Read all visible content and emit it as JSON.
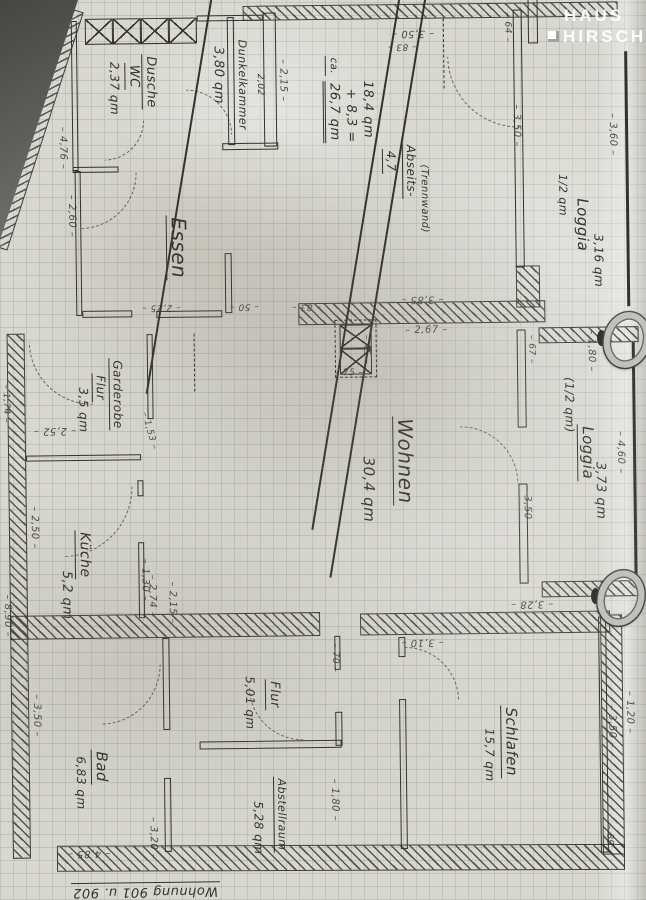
{
  "logo": {
    "line1": "HAUS",
    "line2": "HIRSCH"
  },
  "caption": "Wohnung 901 u. 902",
  "rooms": [
    {
      "name": "Dusche WC",
      "area": "2,37 qm"
    },
    {
      "name": "Dunkelkammer",
      "area": "3,80 qm"
    },
    {
      "name": "Essen",
      "area": ""
    },
    {
      "name": "Loggia (1/2 qm)",
      "area": "3,16 qm"
    },
    {
      "name": "Wohnen",
      "area": "30,4 qm"
    },
    {
      "name": "Loggia (1/2 qm)",
      "area": "3,73 qm"
    },
    {
      "name": "Garderobe Flur",
      "area": "3,5 qm"
    },
    {
      "name": "Küche",
      "area": "5,2 qm"
    },
    {
      "name": "Bad",
      "area": "6,83 qm"
    },
    {
      "name": "Flur",
      "area": "5,01 qm"
    },
    {
      "name": "Abstellraum",
      "area": "5,28 qm"
    },
    {
      "name": "Schlafen",
      "area": "15,7 qm"
    }
  ],
  "plan": {
    "ink": "#34322c",
    "labels": [
      {
        "t": "Dusche",
        "x": 154,
        "y": 80,
        "r": 90,
        "s": 13,
        "u": 1,
        "n": "room-label-dusche"
      },
      {
        "t": "WC",
        "x": 137,
        "y": 74,
        "r": 90,
        "s": 13,
        "u": 1,
        "n": "room-label-wc"
      },
      {
        "t": "2,37 qm",
        "x": 119,
        "y": 86,
        "r": 90,
        "s": 12,
        "n": "area-dusche-wc"
      },
      {
        "t": "Dunkelkammer",
        "x": 247,
        "y": 84,
        "r": 90,
        "s": 11,
        "n": "room-label-dunkelkammer"
      },
      {
        "t": "3,80 qm",
        "x": 223,
        "y": 74,
        "r": 90,
        "s": 13,
        "n": "area-dunkelkammer"
      },
      {
        "t": "2,52",
        "x": 209,
        "y": 48,
        "r": 90,
        "s": 10,
        "strike": 1,
        "n": "crossed-out-number"
      },
      {
        "t": "2,02",
        "x": 264,
        "y": 84,
        "r": 90,
        "s": 9,
        "n": "dimension"
      },
      {
        "t": "Essen",
        "x": 180,
        "y": 246,
        "r": 90,
        "s": 20,
        "u": 1,
        "n": "room-label-essen"
      },
      {
        "t": "1/2 qm",
        "x": 566,
        "y": 198,
        "r": 90,
        "s": 11,
        "n": "note-half-qm"
      },
      {
        "t": "Loggia",
        "x": 585,
        "y": 228,
        "r": 90,
        "s": 15,
        "n": "room-label-loggia-top"
      },
      {
        "t": "3,16 qm",
        "x": 601,
        "y": 264,
        "r": 90,
        "s": 12,
        "n": "area-loggia-top"
      },
      {
        "t": "ca.",
        "x": 336,
        "y": 66,
        "r": 90,
        "s": 10,
        "u": 1,
        "n": "calc-note"
      },
      {
        "t": "18,4 qm",
        "x": 372,
        "y": 110,
        "r": 90,
        "s": 13,
        "n": "calc-line"
      },
      {
        "t": "+ 8,3 =",
        "x": 355,
        "y": 116,
        "r": 90,
        "s": 13,
        "n": "calc-line"
      },
      {
        "t": "26,7 qm",
        "x": 336,
        "y": 112,
        "r": 90,
        "s": 13,
        "u2": 1,
        "n": "calc-sum"
      },
      {
        "t": "22,0",
        "x": 373,
        "y": 176,
        "r": 90,
        "s": 18,
        "strike": 1,
        "n": "calc-crossed"
      },
      {
        "t": "4,7",
        "x": 393,
        "y": 162,
        "r": 90,
        "s": 12,
        "u": 1,
        "n": "calc-line"
      },
      {
        "t": "26,8 qm",
        "x": 391,
        "y": 206,
        "r": 90,
        "s": 13,
        "strike": 1,
        "n": "calc-crossed"
      },
      {
        "t": "Abseits-",
        "x": 413,
        "y": 172,
        "r": 90,
        "s": 12,
        "u": 1,
        "n": "note-abseits"
      },
      {
        "t": "(Trennwand)",
        "x": 427,
        "y": 200,
        "r": 90,
        "s": 10,
        "n": "note-trennwand"
      },
      {
        "t": "Wohnen",
        "x": 404,
        "y": 462,
        "r": 90,
        "s": 20,
        "u": 1,
        "n": "room-label-wohnen"
      },
      {
        "t": "30,4 qm",
        "x": 368,
        "y": 490,
        "r": 90,
        "s": 15,
        "n": "area-wohnen"
      },
      {
        "t": "(1/2 qm)",
        "x": 570,
        "y": 408,
        "r": 90,
        "s": 12,
        "n": "note-half-qm"
      },
      {
        "t": "Loggia",
        "x": 586,
        "y": 456,
        "r": 90,
        "s": 15,
        "u": 1,
        "n": "room-label-loggia-mid"
      },
      {
        "t": "3,73 qm",
        "x": 600,
        "y": 494,
        "r": 90,
        "s": 13,
        "n": "area-loggia-mid"
      },
      {
        "t": "Garderobe",
        "x": 117,
        "y": 392,
        "r": 90,
        "s": 12,
        "u": 1,
        "n": "room-label-garderobe"
      },
      {
        "t": "Flur",
        "x": 100,
        "y": 385,
        "r": 90,
        "s": 12,
        "u": 1,
        "n": "room-label-garderobe-flur"
      },
      {
        "t": "3,5 qm",
        "x": 84,
        "y": 407,
        "r": 90,
        "s": 12,
        "n": "area-garderobe"
      },
      {
        "t": "Küche",
        "x": 82,
        "y": 552,
        "r": 90,
        "s": 14,
        "u": 1,
        "n": "room-label-kueche"
      },
      {
        "t": "5,2 qm",
        "x": 65,
        "y": 592,
        "r": 90,
        "s": 13,
        "n": "area-kueche"
      },
      {
        "t": "Bad",
        "x": 96,
        "y": 764,
        "r": 90,
        "s": 15,
        "u": 1,
        "n": "room-label-bad"
      },
      {
        "t": "6,83 qm",
        "x": 77,
        "y": 780,
        "r": 90,
        "s": 12,
        "n": "area-bad"
      },
      {
        "t": "Flur",
        "x": 270,
        "y": 694,
        "r": 90,
        "s": 13,
        "u": 1,
        "n": "room-label-flur"
      },
      {
        "t": "5,01 qm",
        "x": 247,
        "y": 702,
        "r": 90,
        "s": 12,
        "n": "area-flur"
      },
      {
        "t": "Abstellraum",
        "x": 276,
        "y": 814,
        "r": 90,
        "s": 11,
        "u": 1,
        "n": "room-label-abstellraum"
      },
      {
        "t": "5,28 qm",
        "x": 254,
        "y": 827,
        "r": 90,
        "s": 12,
        "n": "area-abstellraum"
      },
      {
        "t": "Schlafen",
        "x": 506,
        "y": 744,
        "r": 90,
        "s": 15,
        "u": 1,
        "n": "room-label-schlafen"
      },
      {
        "t": "15,7 qm",
        "x": 486,
        "y": 757,
        "r": 90,
        "s": 12,
        "n": "area-schlafen"
      },
      {
        "t": "Wohnung 901 u. 902",
        "x": 140,
        "y": 888,
        "r": 180,
        "s": 13,
        "u": 1,
        "n": "sheet-caption"
      },
      {
        "t": "2,15",
        "x": 287,
        "y": 80,
        "r": 90,
        "s": 10,
        "dim": 1,
        "n": "dimension"
      },
      {
        "t": "4,76",
        "x": 66,
        "y": 145,
        "r": 90,
        "s": 10,
        "dim": 1,
        "n": "dimension"
      },
      {
        "t": "2,60",
        "x": 74,
        "y": 213,
        "r": 90,
        "s": 10,
        "dim": 1,
        "n": "dimension"
      },
      {
        "t": "3,50",
        "x": 418,
        "y": 34,
        "r": 180,
        "s": 10,
        "dim": 1,
        "n": "dimension"
      },
      {
        "t": "83",
        "x": 407,
        "y": 47,
        "r": 180,
        "s": 9,
        "dim": 1,
        "n": "dimension"
      },
      {
        "t": "64",
        "x": 512,
        "y": 30,
        "r": 90,
        "s": 9,
        "dim": 1,
        "n": "dimension"
      },
      {
        "t": "3,50",
        "x": 520,
        "y": 128,
        "r": 90,
        "s": 10,
        "dim": 1,
        "n": "dimension"
      },
      {
        "t": "3,60",
        "x": 616,
        "y": 138,
        "r": 90,
        "s": 10,
        "dim": 1,
        "n": "dimension"
      },
      {
        "t": "2,25",
        "x": 163,
        "y": 305,
        "r": 180,
        "s": 9,
        "dim": 1,
        "n": "dimension"
      },
      {
        "t": "50",
        "x": 246,
        "y": 305,
        "r": 180,
        "s": 9,
        "dim": 1,
        "n": "dimension"
      },
      {
        "t": "83",
        "x": 308,
        "y": 306,
        "r": 180,
        "s": 9,
        "dim": 1,
        "n": "dimension"
      },
      {
        "t": "3,85",
        "x": 424,
        "y": 300,
        "r": 180,
        "s": 10,
        "dim": 1,
        "n": "dimension"
      },
      {
        "t": "2,67",
        "x": 428,
        "y": 332,
        "r": 0,
        "s": 10,
        "dim": 1,
        "n": "dimension"
      },
      {
        "t": "75",
        "x": 350,
        "y": 374,
        "r": 0,
        "s": 9,
        "dim": 1,
        "n": "dimension"
      },
      {
        "t": "45",
        "x": 367,
        "y": 350,
        "r": 90,
        "s": 9,
        "dim": 1,
        "n": "dimension"
      },
      {
        "t": "67",
        "x": 532,
        "y": 352,
        "r": 90,
        "s": 9,
        "dim": 1,
        "n": "dimension"
      },
      {
        "t": "1,80",
        "x": 592,
        "y": 354,
        "r": 90,
        "s": 10,
        "dim": 1,
        "n": "dimension"
      },
      {
        "t": "4,60",
        "x": 620,
        "y": 456,
        "r": 90,
        "s": 10,
        "dim": 1,
        "n": "dimension"
      },
      {
        "t": "3,50",
        "x": 526,
        "y": 510,
        "r": 90,
        "s": 10,
        "dim": 1,
        "n": "dimension"
      },
      {
        "t": "2,52",
        "x": 55,
        "y": 427,
        "r": 180,
        "s": 10,
        "dim": 1,
        "n": "dimension"
      },
      {
        "t": "1,53",
        "x": 149,
        "y": 429,
        "r": 75,
        "s": 9,
        "dim": 1,
        "n": "dimension"
      },
      {
        "t": "1,74",
        "x": 6,
        "y": 400,
        "r": 90,
        "s": 9,
        "dim": 1,
        "n": "dimension"
      },
      {
        "t": "2,50",
        "x": 33,
        "y": 524,
        "r": 90,
        "s": 10,
        "dim": 1,
        "n": "dimension"
      },
      {
        "t": "1,30",
        "x": 143,
        "y": 578,
        "r": 90,
        "s": 10,
        "dim": 1,
        "n": "dimension"
      },
      {
        "t": "2,74",
        "x": 150,
        "y": 594,
        "r": 90,
        "s": 10,
        "dim": 1,
        "n": "dimension"
      },
      {
        "t": "2,15",
        "x": 170,
        "y": 601,
        "r": 90,
        "s": 10,
        "dim": 1,
        "n": "dimension"
      },
      {
        "t": "3,28",
        "x": 530,
        "y": 606,
        "r": 180,
        "s": 10,
        "dim": 1,
        "n": "dimension"
      },
      {
        "t": "8,90",
        "x": 5,
        "y": 612,
        "r": 90,
        "s": 10,
        "dim": 1,
        "n": "dimension"
      },
      {
        "t": "3,50",
        "x": 33,
        "y": 712,
        "r": 90,
        "s": 10,
        "dim": 1,
        "n": "dimension"
      },
      {
        "t": "3,20",
        "x": 148,
        "y": 836,
        "r": 90,
        "s": 10,
        "dim": 1,
        "n": "dimension"
      },
      {
        "t": "70",
        "x": 332,
        "y": 658,
        "r": 90,
        "s": 9,
        "dim": 1,
        "n": "dimension"
      },
      {
        "t": "3,10",
        "x": 420,
        "y": 643,
        "r": 180,
        "s": 10,
        "dim": 1,
        "n": "dimension"
      },
      {
        "t": "1,80",
        "x": 330,
        "y": 800,
        "r": 90,
        "s": 10,
        "dim": 1,
        "n": "dimension"
      },
      {
        "t": "3,50",
        "x": 608,
        "y": 730,
        "r": 90,
        "s": 10,
        "dim": 1,
        "n": "dimension"
      },
      {
        "t": "1,20",
        "x": 626,
        "y": 716,
        "r": 90,
        "s": 10,
        "dim": 1,
        "n": "dimension"
      },
      {
        "t": "89",
        "x": 604,
        "y": 843,
        "r": 90,
        "s": 9,
        "dim": 1,
        "n": "dimension"
      },
      {
        "t": "4,85",
        "x": 84,
        "y": 850,
        "r": 180,
        "s": 10,
        "dim": 1,
        "n": "dimension"
      }
    ],
    "walls": [
      {
        "type": "hatch",
        "x": 248,
        "y": 5,
        "w": 375,
        "h": 15
      },
      {
        "type": "hatch",
        "x": -85,
        "y": 115,
        "w": 250,
        "h": 20,
        "r": -71.5
      },
      {
        "type": "hatch",
        "x": 300,
        "y": 303,
        "w": 247,
        "h": 22
      },
      {
        "type": "hatch",
        "x": 540,
        "y": 330,
        "w": 100,
        "h": 16
      },
      {
        "type": "hatch",
        "x": 540,
        "y": 584,
        "w": 100,
        "h": 16
      },
      {
        "type": "hatch",
        "x": 8,
        "y": 330,
        "w": 18,
        "h": 525
      },
      {
        "type": "hatch",
        "x": 52,
        "y": 845,
        "w": 568,
        "h": 26,
        "r": 0.5
      },
      {
        "type": "hatch",
        "x": 8,
        "y": 612,
        "w": 310,
        "h": 24
      },
      {
        "type": "hatch",
        "x": 358,
        "y": 614,
        "w": 250,
        "h": 22
      },
      {
        "type": "hatch",
        "x": 598,
        "y": 618,
        "w": 22,
        "h": 240
      },
      {
        "type": "hatch",
        "x": 518,
        "y": 268,
        "w": 24,
        "h": 42
      },
      {
        "type": "wall2",
        "x": 76,
        "y": 18,
        "w": 6,
        "h": 150
      },
      {
        "type": "window",
        "x": 90,
        "y": 16,
        "w": 28,
        "h": 26
      },
      {
        "type": "window",
        "x": 118,
        "y": 16,
        "w": 28,
        "h": 26
      },
      {
        "type": "window",
        "x": 146,
        "y": 16,
        "w": 28,
        "h": 26
      },
      {
        "type": "window",
        "x": 174,
        "y": 16,
        "w": 28,
        "h": 26
      },
      {
        "type": "wall2",
        "x": 202,
        "y": 14,
        "w": 66,
        "h": 6
      },
      {
        "type": "wall2",
        "x": 232,
        "y": 16,
        "w": 7,
        "h": 128
      },
      {
        "type": "wall2",
        "x": 268,
        "y": 12,
        "w": 13,
        "h": 134
      },
      {
        "type": "wall2",
        "x": 226,
        "y": 142,
        "w": 56,
        "h": 7
      },
      {
        "type": "wall2",
        "x": 76,
        "y": 164,
        "w": 46,
        "h": 6
      },
      {
        "type": "wall2",
        "x": 78,
        "y": 168,
        "w": 6,
        "h": 145
      },
      {
        "type": "wall2",
        "x": 84,
        "y": 308,
        "w": 50,
        "h": 7
      },
      {
        "type": "wall2",
        "x": 158,
        "y": 309,
        "w": 66,
        "h": 7
      },
      {
        "type": "wall2",
        "x": 227,
        "y": 252,
        "w": 7,
        "h": 60
      },
      {
        "type": "wall2",
        "x": 518,
        "y": 12,
        "w": 9,
        "h": 258
      },
      {
        "type": "wall2",
        "x": 533,
        "y": 0,
        "w": 10,
        "h": 46
      },
      {
        "type": "line",
        "x": 629,
        "y": 55,
        "w": 3,
        "h": 255
      },
      {
        "type": "wall2",
        "x": 518,
        "y": 332,
        "w": 9,
        "h": 98
      },
      {
        "type": "wall2",
        "x": 518,
        "y": 486,
        "w": 9,
        "h": 100
      },
      {
        "type": "line",
        "x": 633,
        "y": 346,
        "w": 3,
        "h": 238
      },
      {
        "type": "wall2",
        "x": 148,
        "y": 332,
        "w": 6,
        "h": 85
      },
      {
        "type": "wall2",
        "x": 26,
        "y": 452,
        "w": 115,
        "h": 6
      },
      {
        "type": "wall2",
        "x": 137,
        "y": 478,
        "w": 6,
        "h": 16
      },
      {
        "type": "wall2",
        "x": 137,
        "y": 540,
        "w": 6,
        "h": 76
      },
      {
        "type": "wall2",
        "x": 160,
        "y": 636,
        "w": 7,
        "h": 92
      },
      {
        "type": "wall2",
        "x": 160,
        "y": 776,
        "w": 7,
        "h": 74
      },
      {
        "type": "wall2",
        "x": 196,
        "y": 740,
        "w": 142,
        "h": 8
      },
      {
        "type": "wall2",
        "x": 332,
        "y": 636,
        "w": 6,
        "h": 34
      },
      {
        "type": "wall2",
        "x": 332,
        "y": 712,
        "w": 7,
        "h": 34
      },
      {
        "type": "wall2",
        "x": 396,
        "y": 638,
        "w": 7,
        "h": 20
      },
      {
        "type": "wall2",
        "x": 396,
        "y": 700,
        "w": 7,
        "h": 150
      },
      {
        "type": "wall2",
        "x": 596,
        "y": 620,
        "w": 8,
        "h": 236
      },
      {
        "type": "window",
        "x": 341,
        "y": 325,
        "w": 32,
        "h": 24
      },
      {
        "type": "window",
        "x": 341,
        "y": 349,
        "w": 32,
        "h": 26
      },
      {
        "type": "dashbox",
        "x": 336,
        "y": 320,
        "w": 42,
        "h": 58
      },
      {
        "type": "dashline",
        "x": 195,
        "y": 332,
        "w": 2,
        "h": 58
      },
      {
        "type": "dashline",
        "x": 448,
        "y": 20,
        "w": 2,
        "h": 70
      }
    ],
    "arcs": [
      {
        "x": 84,
        "y": 170,
        "s": 56,
        "r": 90
      },
      {
        "x": 452,
        "y": 58,
        "s": 72,
        "r": 180
      },
      {
        "x": 30,
        "y": 338,
        "s": 64,
        "r": 180
      },
      {
        "x": 62,
        "y": 484,
        "s": 70,
        "r": 90
      },
      {
        "x": 460,
        "y": 428,
        "s": 58,
        "r": 0
      },
      {
        "x": 98,
        "y": 662,
        "s": 60,
        "r": 90
      },
      {
        "x": 402,
        "y": 648,
        "s": 54,
        "r": 0
      },
      {
        "x": 246,
        "y": 686,
        "s": 54,
        "r": 180
      },
      {
        "x": 190,
        "y": 88,
        "s": 46,
        "r": 0
      },
      {
        "x": 108,
        "y": 118,
        "s": 40,
        "r": 90
      }
    ]
  }
}
